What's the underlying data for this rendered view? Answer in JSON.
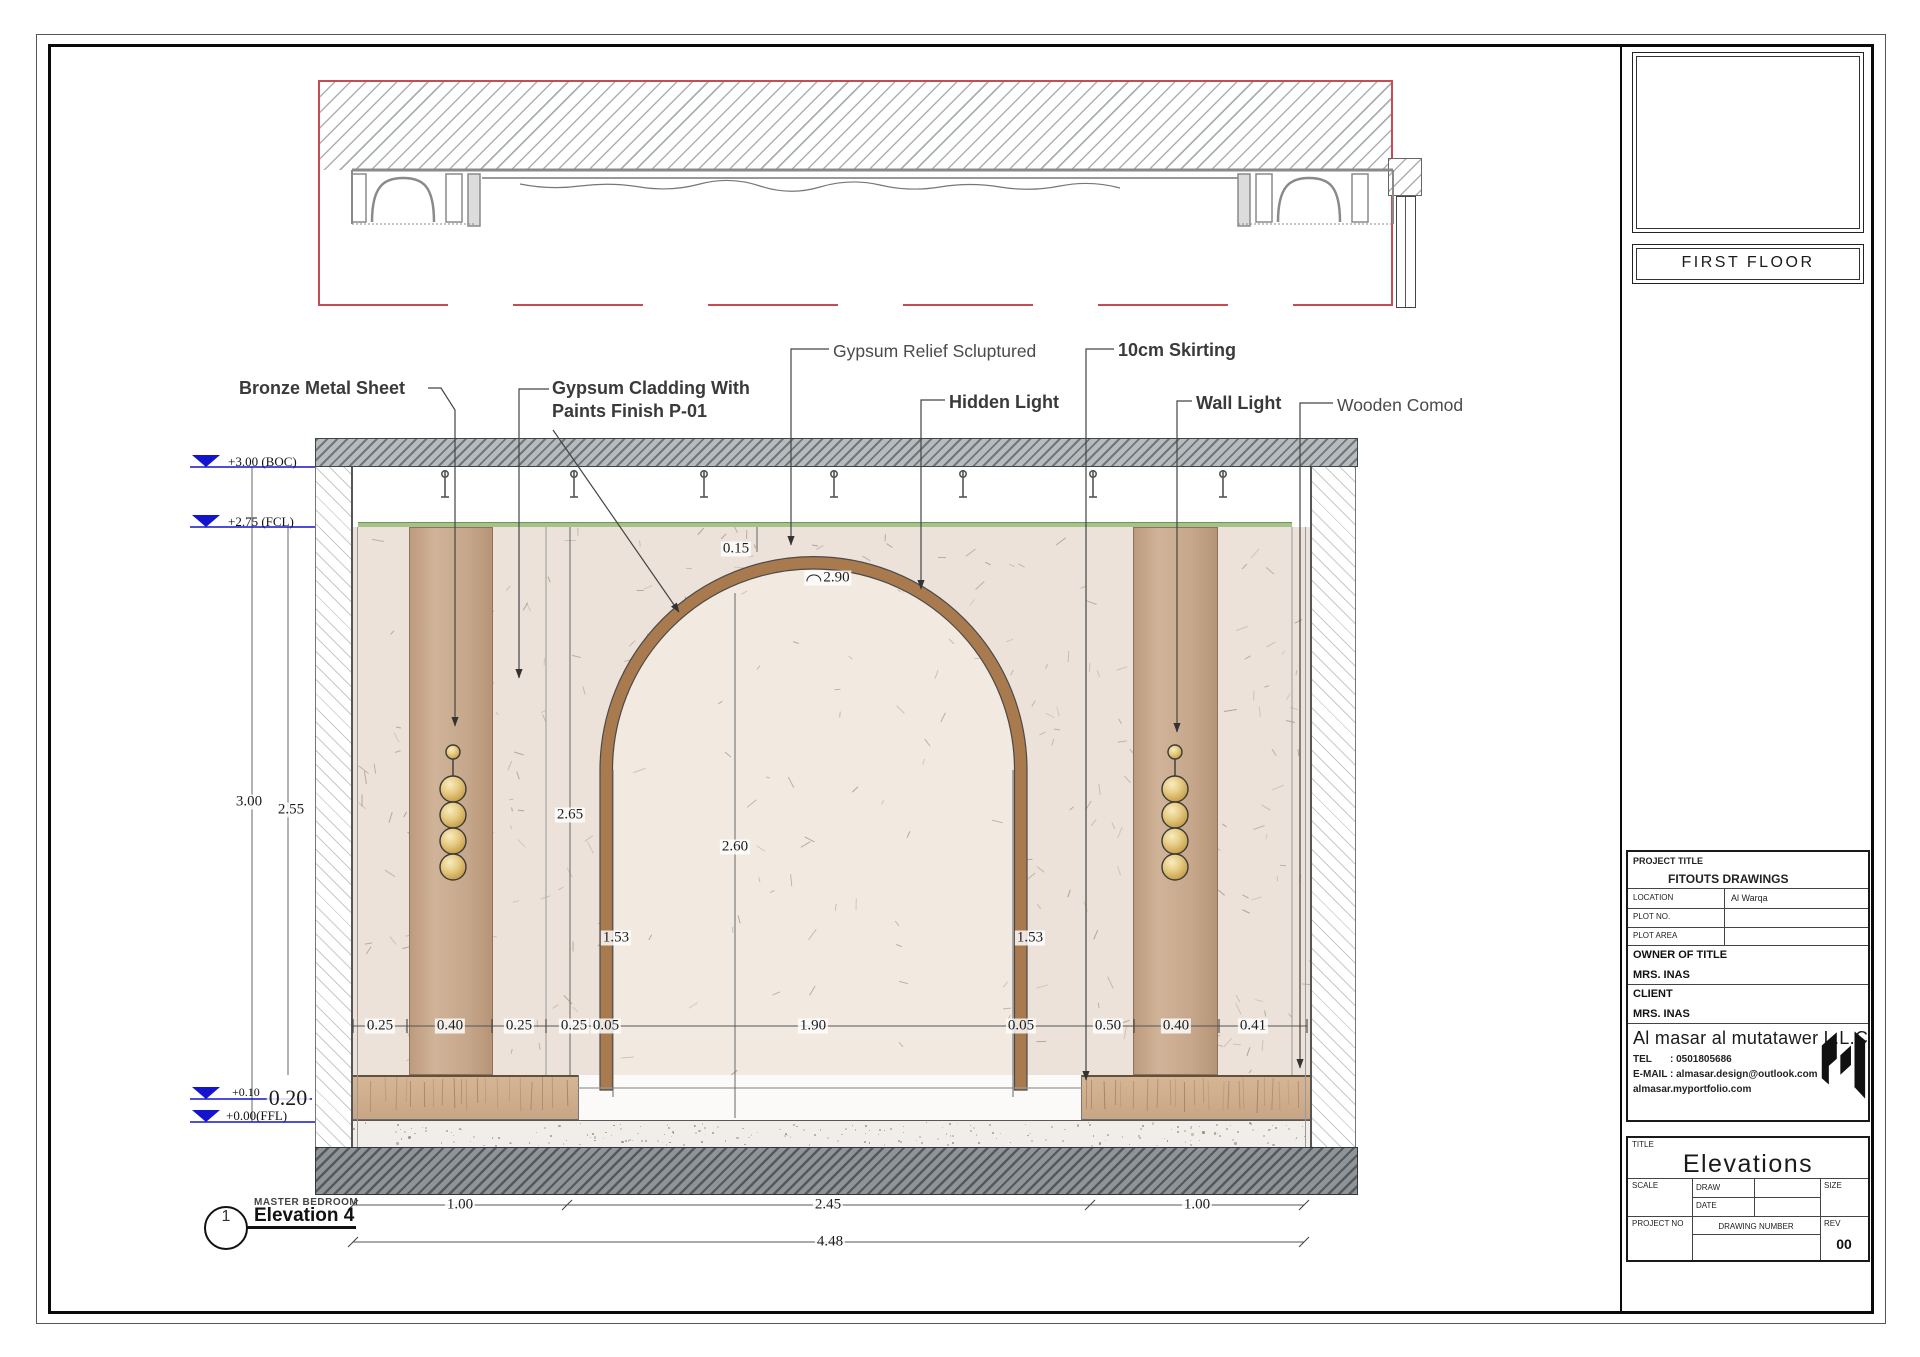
{
  "labels": {
    "bronze": "Bronze Metal Sheet",
    "cladding1": "Gypsum Cladding With",
    "cladding2": "Paints Finish P-01",
    "relief": "Gypsum Relief Scluptured",
    "hidden_light": "Hidden Light",
    "skirting": "10cm Skirting",
    "wall_light": "Wall Light",
    "wooden_comod": "Wooden Comod"
  },
  "levels": {
    "boc": "+3.00 (BOC)",
    "fcl": "+2.75 (FCL)",
    "p010": "+0.10",
    "ffl": "+0.00(FFL)",
    "h020": "0.20"
  },
  "dims": {
    "d015": "0.15",
    "d290": "2.90",
    "d300": "3.00",
    "d255": "2.55",
    "d265": "2.65",
    "d260": "2.60",
    "d153L": "1.53",
    "d153R": "1.53",
    "bottom": [
      "0.25",
      "0.40",
      "0.25",
      "0.25",
      "0.05",
      "1.90",
      "0.05",
      "0.50",
      "0.40",
      "0.41"
    ],
    "mid": [
      "1.00",
      "2.45",
      "1.00"
    ],
    "total": "4.48"
  },
  "view_marker": {
    "number": "1",
    "room": "MASTER BEDROOM",
    "title": "Elevation 4"
  },
  "titleblock": {
    "floor": "FIRST FLOOR",
    "project_title_label": "PROJECT TITLE",
    "project_title": "FITOUTS DRAWINGS",
    "location_label": "LOCATION",
    "location": "Al Warqa",
    "plot_no_label": "PLOT NO.",
    "plot_area_label": "PLOT AREA",
    "owner_label": "OWNER OF TITLE",
    "owner": "MRS. INAS",
    "client_label": "CLIENT",
    "client": "MRS. INAS",
    "company": "Al masar al mutatawer L.L.C",
    "tel_label": "TEL",
    "tel": ": 0501805686",
    "email_label": "E-MAIL",
    "email": ": almasar.design@outlook.com",
    "website": "almasar.myportfolio.com",
    "title_label": "TITLE",
    "sheet_title": "Elevations",
    "scale_label": "SCALE",
    "draw_label": "DRAW",
    "date_label": "DATE",
    "size_label": "SIZE",
    "project_no_label": "PROJECT NO",
    "drawing_number_label": "DRAWING NUMBER",
    "rev_label": "REV",
    "rev": "00"
  },
  "colors": {
    "red_line": "#c84a52",
    "level_blue": "#1414cc",
    "arch_brown": "#a87a4e",
    "panel_tan": "#c6a78b",
    "light_gold": "#e7cc85",
    "ceiling_green": "#a6c18a"
  }
}
